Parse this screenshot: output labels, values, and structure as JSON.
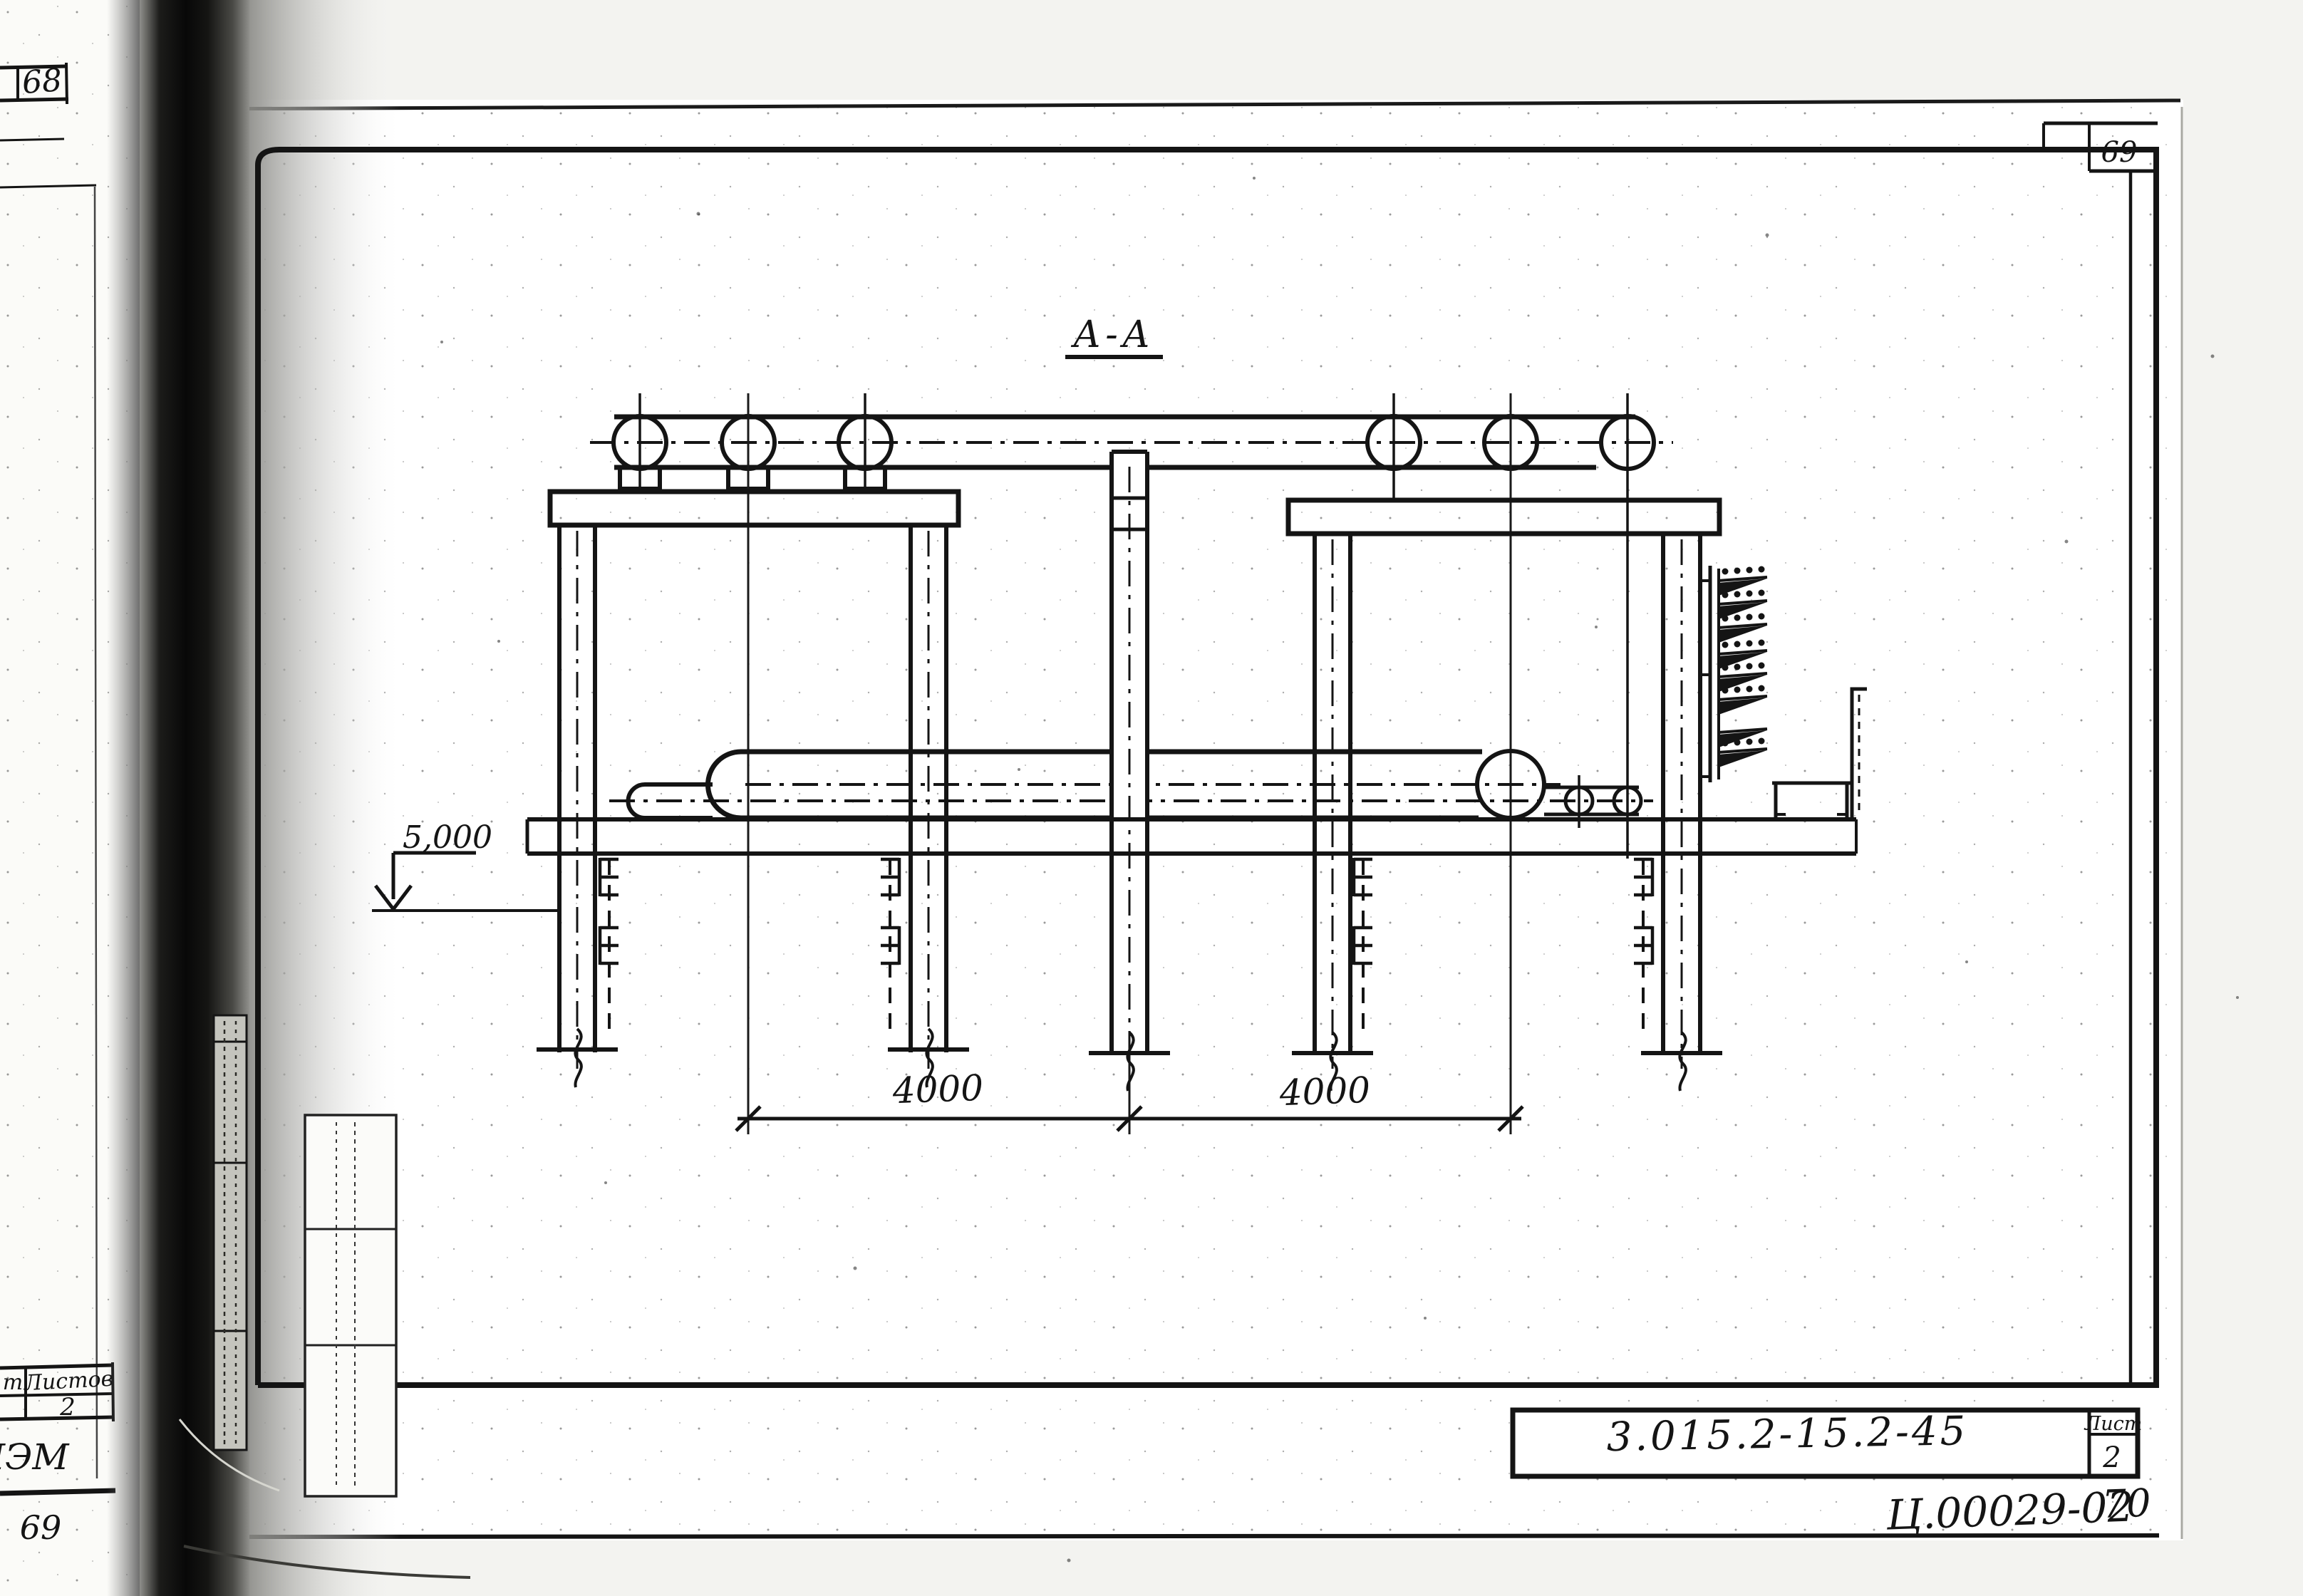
{
  "left_page": {
    "top_page_number": "68",
    "bottom_page_number": "69",
    "sheets_table": {
      "header_fragment": "т",
      "sheets_header": "Листов",
      "sheets_value": "2"
    },
    "handwritten_code": "ПЭМ"
  },
  "sheet": {
    "top_right_page_number": "69",
    "section_label": "А-А",
    "elevation": {
      "value": "5,000"
    },
    "dimensions": {
      "left": "4000",
      "right": "4000"
    },
    "title_block": {
      "document_number": "3.015.2-15.2-45",
      "sheet_label": "Лист",
      "sheet_value": "2"
    },
    "footer": {
      "inventory_number": "Ц.00029-02",
      "page_number": "70"
    }
  },
  "colors": {
    "ink": "#141414",
    "paper": "#ffffff",
    "gutter_dark": "#080808"
  }
}
